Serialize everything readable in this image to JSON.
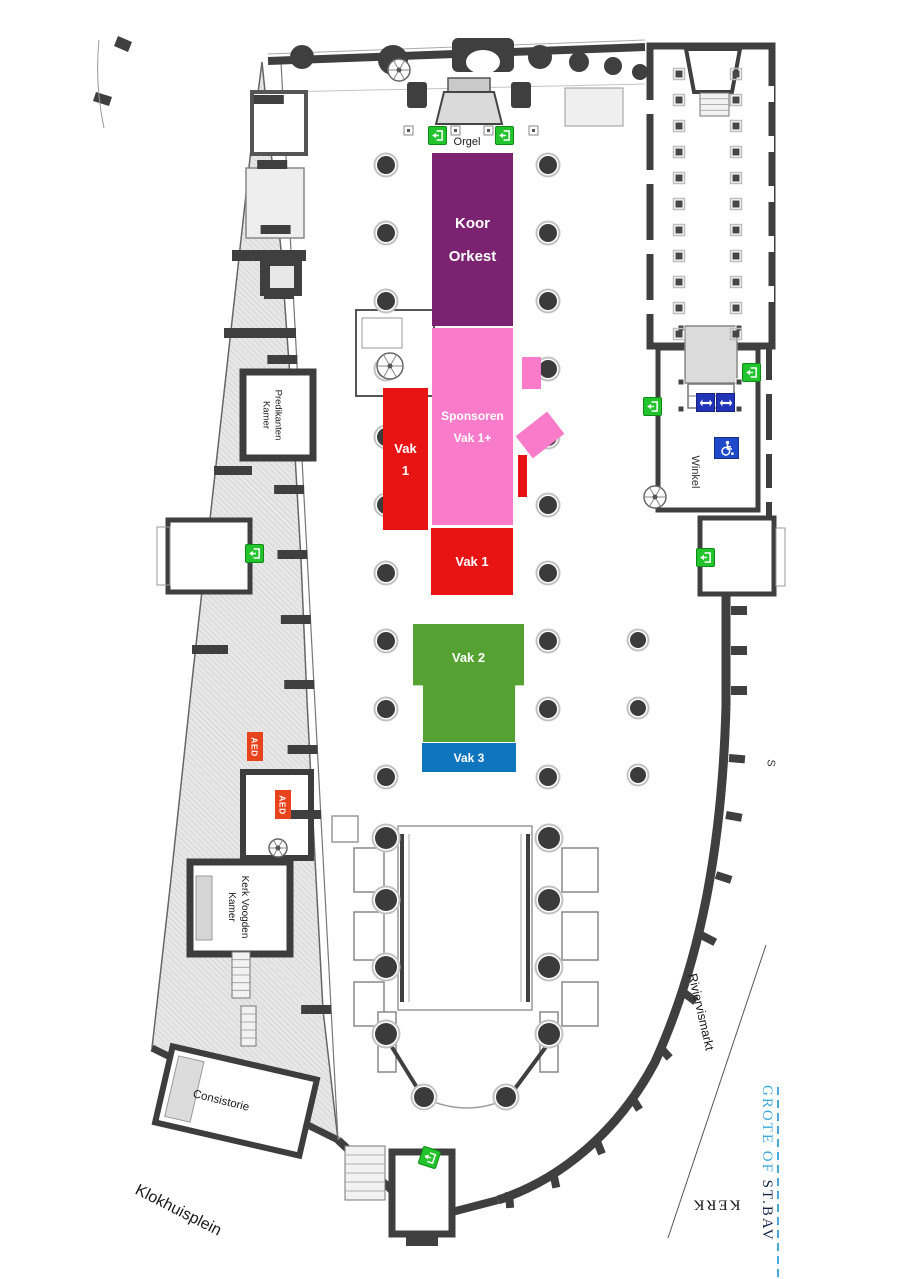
{
  "plan": {
    "organ_label": "Orgel",
    "zones": {
      "koor_orkest": {
        "line1": "Koor",
        "line2": "Orkest",
        "color": "#7B2371"
      },
      "sponsoren": {
        "line1": "Sponsoren",
        "line2": "Vak 1+",
        "color": "#F97BC9"
      },
      "vak1_side": {
        "line1": "Vak",
        "line2": "1",
        "color": "#E81414"
      },
      "vak1_front": {
        "label": "Vak 1",
        "color": "#E81414"
      },
      "vak2": {
        "label": "Vak 2",
        "color": "#55A233"
      },
      "vak3": {
        "label": "Vak 3",
        "color": "#0F76BE"
      }
    },
    "rooms": {
      "predikanten_kamer": {
        "line1": "Predikanten",
        "line2": "Kamer"
      },
      "kerk_voogden_kamer": {
        "line1": "Kerk Voogden",
        "line2": "Kamer"
      },
      "consistorie": "Consistorie",
      "winkel": "Winkel"
    },
    "streets": {
      "klokhuisplein": "Klokhuisplein",
      "riviervismarkt": "Riviervismarkt",
      "grote_of": "GROTE OF ",
      "st_bav": "ST.BAV",
      "kerk": "KERK",
      "edge_letter": "S"
    },
    "safety": {
      "aed": "AED"
    },
    "icon_colors": {
      "exit_green": "#23C32D",
      "wc_blue": "#2134B8",
      "wheelchair_blue": "#1F49C8",
      "aed_red": "#E8431C",
      "street_dash_blue": "#49A8D8"
    }
  }
}
